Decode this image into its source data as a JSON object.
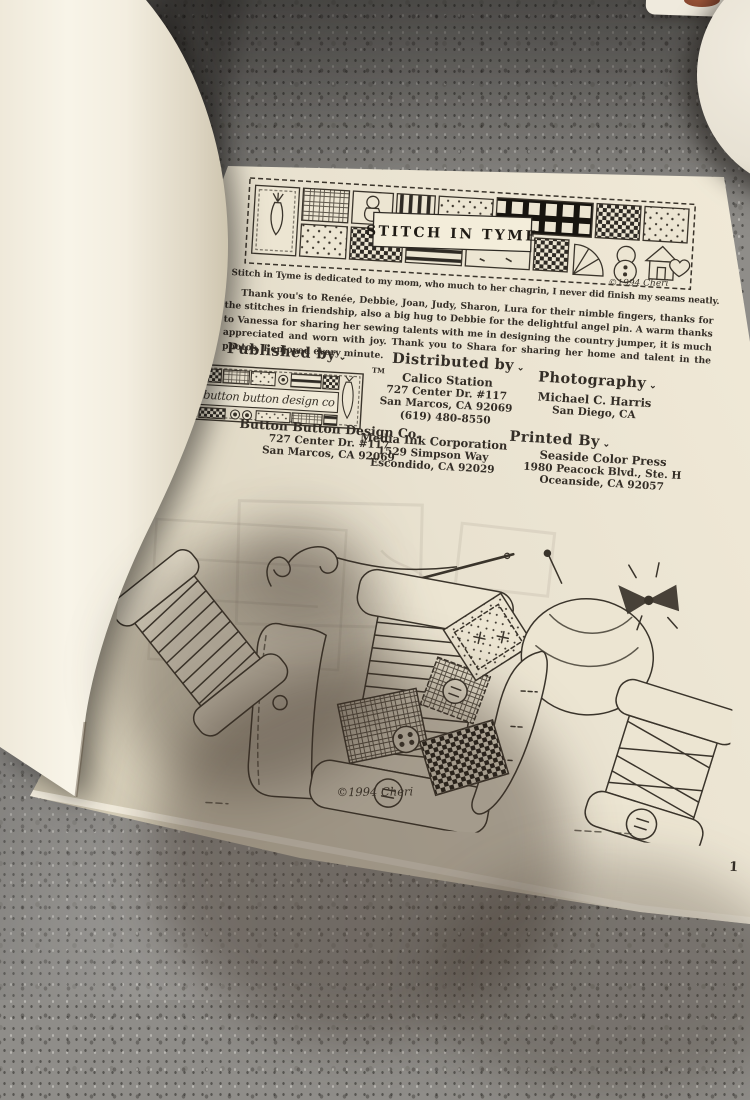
{
  "photo": {
    "page": {
      "banner_title": "STITCH IN TYME",
      "banner_signature": "©1994 Cheri",
      "dedication": "Stitch in Tyme is dedicated to my mom, who much to her chagrin, I never did finish my seams neatly.",
      "acknowledgement": "Thank you's to Renée, Debbie, Joan, Judy, Sharon, Lura for their nimble fingers, thanks for the stitches in friendship, also a big hug to Debbie for the delightful angel pin. A warm thanks to Vanessa for sharing her sewing talents with me in designing the country jumper, it is much appreciated and worn with joy. Thank you to Shara for sharing her home and talent in the photos, I enjoyed every minute.",
      "published": {
        "heading": "Published by",
        "mark": "⌄",
        "logo_text": "button button design co",
        "trademark": "TM",
        "name": "Button Button Design Co.",
        "address1": "727 Center Dr. #117",
        "address2": "San Marcos, CA 92069"
      },
      "distributed": {
        "heading": "Distributed by",
        "mark": "⌄",
        "name": "Calico Station",
        "address1": "727 Center Dr. #117",
        "address2": "San Marcos, CA 92069",
        "phone": "(619) 480-8550"
      },
      "photography": {
        "heading": "Photography",
        "mark": "⌄",
        "name": "Michael C. Harris",
        "address1": "San Diego, CA"
      },
      "media": {
        "name": "Media Ink Corporation",
        "address1": "1529 Simpson Way",
        "address2": "Escondido, CA 92029"
      },
      "printed": {
        "heading": "Printed By",
        "mark": "⌄",
        "name": "Seaside Color Press",
        "address1": "1980 Peacock Blvd., Ste. H",
        "address2": "Oceanside, CA 92057"
      },
      "illustration_signature": "©1994 Cheri",
      "page_number": "1"
    },
    "colors": {
      "countertop": "#8f8d89",
      "page_cream": "#e9e2d0",
      "cover_white": "#f6f2e5",
      "ink": "#332d26",
      "bowl_white": "#eae4d6",
      "jar_lid_brown": "#8a4a33"
    }
  }
}
